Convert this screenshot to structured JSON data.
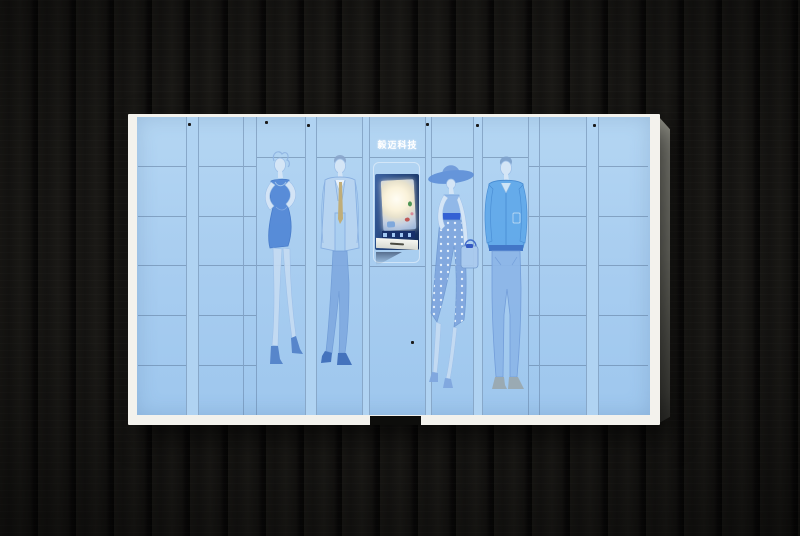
{
  "meta": {
    "image_type": "product photograph",
    "subject": "smart clothing/parcel locker cabinet mounted on a dark wood plank wall"
  },
  "background": {
    "material": "dark wood planks",
    "base_color": "#141311",
    "gap_color": "#060605"
  },
  "cabinet": {
    "brand_label": "毅迈科技",
    "frame_color": "#f3f2ed",
    "door_color": "#a8cdf0",
    "strip_color": "#b0d3f2",
    "seam_color": "#587496",
    "side_panel_color": "#7b7b72",
    "lock_dot_color": "#1b1b1b",
    "left_grid": {
      "columns": 2,
      "rows": 6
    },
    "right_grid": {
      "columns": 2,
      "rows": 6
    },
    "narrow_columns": {
      "count": 2,
      "rows": 6
    },
    "figure_doors": [
      {
        "name": "woman-evening-dress",
        "artwork": "fashion sketch of woman in fitted sleeveless dress and ankle boots"
      },
      {
        "name": "man-business-suit",
        "artwork": "fashion sketch of man in light suit with gold tie"
      },
      {
        "name": "woman-sun-hat",
        "artwork": "fashion sketch of woman in wide-brim hat, polka-dot skirt, handbag"
      },
      {
        "name": "man-casual-jacket",
        "artwork": "fashion sketch of man in casual jacket and jeans"
      }
    ],
    "kiosk": {
      "screen_frame_color": "#244680",
      "screen_glow_color": "#fffdf4",
      "icon_row_color": "#16306a",
      "sill_color": "#e9eae4",
      "has_card_slot": true,
      "door_lock": true,
      "base_notch_color": "#0d0d0b"
    }
  }
}
